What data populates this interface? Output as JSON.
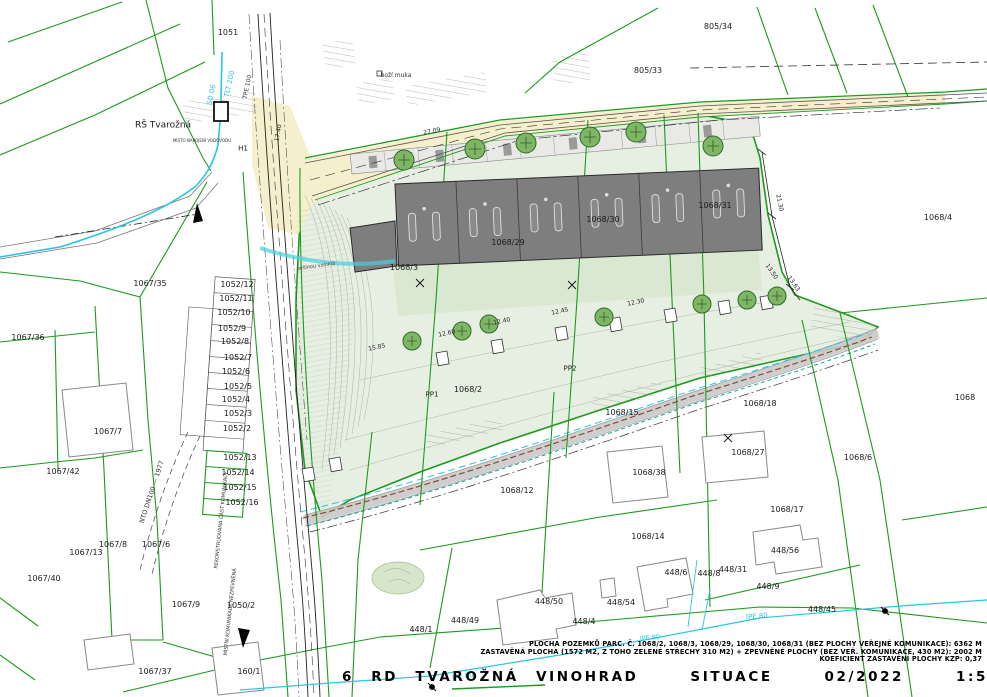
{
  "colors": {
    "cadastre_green": "#1c9a1c",
    "site_fill": "#e7efe2",
    "garden_fill": "#d9e7cf",
    "road_fill": "#f6efcd",
    "building_gray": "#7e7e7e",
    "water_cyan": "#2ac4e4",
    "sewer_brown": "#8a4b38",
    "heat_teal": "#1fa39b",
    "tree_green": "#7fb565",
    "contour_gray": "#a8ad9b"
  },
  "title_block": {
    "line1": "PLOCHA POZEMKŮ PARC. Č. 1068/2, 1068/3, 1068/29, 1068/30, 1068/31 (BEZ PLOCHY VEŘEJNÉ KOMUNIKACE): ",
    "line1_value": "6362 M",
    "line2": "ZASTAVĚNÁ PLOCHA (1572 M2, Z TOHO ZELENÉ STŘECHY 310 M2) + ZPEVNĚNÉ PLOCHY (BEZ VEŘ. KOMUNIKACE, 430 M2): ",
    "line2_value": "2002 M",
    "line3": "KOEFICIENT ZASTAVĚNÍ PLOCHY KZP: ",
    "line3_value": "0,37",
    "title": "6 RD TVAROŽNÁ VINOHRAD   SITUACE   02/2022   1:500"
  },
  "map_labels": {
    "parcels": [
      {
        "text": "1051",
        "x": 228,
        "y": 33
      },
      {
        "text": "805/34",
        "x": 718,
        "y": 27
      },
      {
        "text": "805/33",
        "x": 648,
        "y": 71
      },
      {
        "text": "1067/35",
        "x": 150,
        "y": 284
      },
      {
        "text": "1067/36",
        "x": 28,
        "y": 338
      },
      {
        "text": "1052/12",
        "x": 237,
        "y": 285
      },
      {
        "text": "1052/11",
        "x": 236,
        "y": 299
      },
      {
        "text": "1052/10",
        "x": 234,
        "y": 313
      },
      {
        "text": "1052/9",
        "x": 232,
        "y": 329
      },
      {
        "text": "1052/8",
        "x": 235,
        "y": 342
      },
      {
        "text": "1052/7",
        "x": 238,
        "y": 358
      },
      {
        "text": "1052/6",
        "x": 236,
        "y": 372
      },
      {
        "text": "1052/5",
        "x": 238,
        "y": 387
      },
      {
        "text": "1052/4",
        "x": 236,
        "y": 400
      },
      {
        "text": "1052/3",
        "x": 238,
        "y": 414
      },
      {
        "text": "1052/2",
        "x": 237,
        "y": 429
      },
      {
        "text": "1052/13",
        "x": 240,
        "y": 458
      },
      {
        "text": "1052/14",
        "x": 238,
        "y": 473
      },
      {
        "text": "1052/15",
        "x": 240,
        "y": 488
      },
      {
        "text": "1052/16",
        "x": 242,
        "y": 503
      },
      {
        "text": "1067/7",
        "x": 108,
        "y": 432
      },
      {
        "text": "1067/42",
        "x": 63,
        "y": 472
      },
      {
        "text": "1067/13",
        "x": 86,
        "y": 553
      },
      {
        "text": "1067/8",
        "x": 113,
        "y": 545
      },
      {
        "text": "1067/6",
        "x": 156,
        "y": 545
      },
      {
        "text": "1067/40",
        "x": 44,
        "y": 579
      },
      {
        "text": "1067/9",
        "x": 186,
        "y": 605
      },
      {
        "text": "1050/2",
        "x": 241,
        "y": 606
      },
      {
        "text": "1067/37",
        "x": 155,
        "y": 672
      },
      {
        "text": "160/1",
        "x": 249,
        "y": 672
      },
      {
        "text": "1068/3",
        "x": 404,
        "y": 268
      },
      {
        "text": "1068/29",
        "x": 508,
        "y": 243
      },
      {
        "text": "1068/30",
        "x": 603,
        "y": 220
      },
      {
        "text": "1068/31",
        "x": 715,
        "y": 206
      },
      {
        "text": "1068/4",
        "x": 938,
        "y": 218
      },
      {
        "text": "1068",
        "x": 965,
        "y": 398
      },
      {
        "text": "1068/6",
        "x": 858,
        "y": 458
      },
      {
        "text": "1068/18",
        "x": 760,
        "y": 404
      },
      {
        "text": "1068/15",
        "x": 622,
        "y": 413
      },
      {
        "text": "1068/12",
        "x": 517,
        "y": 491
      },
      {
        "text": "1068/38",
        "x": 649,
        "y": 473
      },
      {
        "text": "1068/27",
        "x": 748,
        "y": 453
      },
      {
        "text": "1068/17",
        "x": 787,
        "y": 510
      },
      {
        "text": "1068/14",
        "x": 648,
        "y": 537
      },
      {
        "text": "448/56",
        "x": 785,
        "y": 551
      },
      {
        "text": "448/6",
        "x": 676,
        "y": 573
      },
      {
        "text": "448/8",
        "x": 709,
        "y": 574
      },
      {
        "text": "448/31",
        "x": 733,
        "y": 570
      },
      {
        "text": "448/9",
        "x": 768,
        "y": 587
      },
      {
        "text": "448/54",
        "x": 621,
        "y": 603
      },
      {
        "text": "448/45",
        "x": 822,
        "y": 610
      },
      {
        "text": "448/50",
        "x": 549,
        "y": 602
      },
      {
        "text": "448/49",
        "x": 465,
        "y": 621
      },
      {
        "text": "448/4",
        "x": 584,
        "y": 622
      },
      {
        "text": "448/1",
        "x": 421,
        "y": 630
      },
      {
        "text": "1068/2",
        "x": 468,
        "y": 390
      },
      {
        "text": "PP1",
        "x": 432,
        "y": 395,
        "size": 7
      },
      {
        "text": "PP2",
        "x": 570,
        "y": 369,
        "size": 7
      }
    ],
    "utilities": [
      {
        "text": "RŠ Tvarožná",
        "x": 163,
        "y": 126,
        "size": 9
      },
      {
        "text": "H1",
        "x": 243,
        "y": 149,
        "size": 7
      },
      {
        "text": "MÍSTO NAPOJENÍ VODOVODU",
        "x": 202,
        "y": 141,
        "size": 4,
        "color": "#333"
      },
      {
        "text": "SO 06",
        "x": 212,
        "y": 95,
        "size": 7,
        "rot": -78,
        "color": "#2ac4e4"
      },
      {
        "text": "TLT 200",
        "x": 230,
        "y": 84,
        "size": 7,
        "rot": -78,
        "color": "#2ac4e4"
      },
      {
        "text": "TPE 100",
        "x": 248,
        "y": 87,
        "size": 6,
        "rot": -78,
        "color": "#333"
      },
      {
        "text": "NTO DN100 — 1977",
        "x": 152,
        "y": 492,
        "size": 6.5,
        "rot": -72,
        "color": "#333"
      },
      {
        "text": "lPE 80",
        "x": 463,
        "y": 677,
        "size": 7,
        "rot": -8,
        "color": "#2ac4e4"
      },
      {
        "text": "lPE 80",
        "x": 650,
        "y": 638,
        "size": 6.5,
        "rot": -6,
        "color": "#2ac4e4"
      },
      {
        "text": "lPE 80",
        "x": 757,
        "y": 617,
        "size": 7,
        "rot": -5,
        "color": "#2ac4e4"
      }
    ],
    "dimensions": [
      {
        "text": "27.09",
        "x": 432,
        "y": 132,
        "size": 6,
        "rot": -10,
        "color": "#222"
      },
      {
        "text": "17.40",
        "x": 279,
        "y": 133,
        "size": 6,
        "rot": -80,
        "color": "#222"
      },
      {
        "text": "21.30",
        "x": 779,
        "y": 203,
        "size": 6,
        "rot": 78,
        "color": "#222"
      },
      {
        "text": "13.50",
        "x": 771,
        "y": 272,
        "size": 6,
        "rot": 55,
        "color": "#222"
      },
      {
        "text": "13.63",
        "x": 793,
        "y": 284,
        "size": 6,
        "rot": 55,
        "color": "#222"
      },
      {
        "text": "15.85",
        "x": 377,
        "y": 348,
        "size": 6,
        "rot": -12,
        "color": "#222"
      },
      {
        "text": "12.60",
        "x": 447,
        "y": 334,
        "size": 6,
        "rot": -12,
        "color": "#222"
      },
      {
        "text": "12.40",
        "x": 502,
        "y": 322,
        "size": 6,
        "rot": -12,
        "color": "#222"
      },
      {
        "text": "12.45",
        "x": 560,
        "y": 312,
        "size": 6,
        "rot": -12,
        "color": "#222"
      },
      {
        "text": "12.30",
        "x": 636,
        "y": 303,
        "size": 6,
        "rot": -12,
        "color": "#222"
      }
    ],
    "annotations": [
      {
        "text": "boží muka",
        "x": 396,
        "y": 76,
        "size": 6,
        "color": "#333"
      },
      {
        "text": "pěšinou vzniklá",
        "x": 316,
        "y": 267,
        "size": 5,
        "rot": -8,
        "color": "#444"
      },
      {
        "text": "REKONSTRUOVANÁ ČÁST KOMUNIKACE",
        "x": 222,
        "y": 520,
        "size": 5,
        "rot": -84,
        "color": "#333"
      },
      {
        "text": "MÍSTNÍ KOMUNIKACE NEZPEVNĚNÁ",
        "x": 231,
        "y": 612,
        "size": 5,
        "rot": -84,
        "color": "#333"
      }
    ]
  }
}
